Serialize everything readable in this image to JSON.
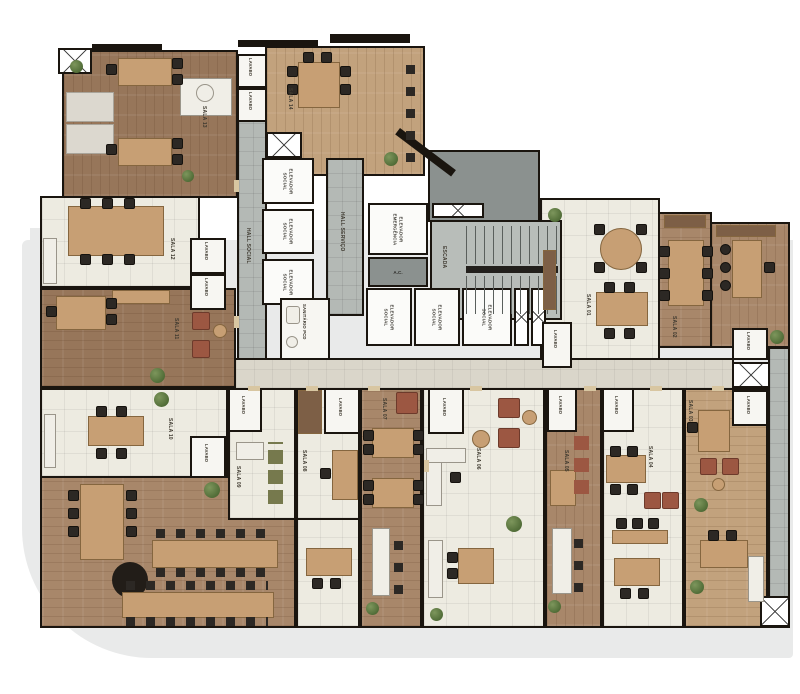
{
  "plan_type": "floor-plan",
  "labels": {
    "lavabo": "LAVABO",
    "elevador_social": "ELEVADOR SOCIAL",
    "elevador_emergencia": "ELEVADOR EMERGÊNCIA",
    "escada": "ESCADA",
    "hall_social": "HALL SOCIAL",
    "hall_servico": "HALL SERVIÇO",
    "ac": "A.C.",
    "sanitario_pcd": "SANITÁRIO PCD"
  },
  "salas": {
    "s01": "SALA 01",
    "s02": "SALA 02",
    "s03": "SALA 03",
    "s04": "SALA 04",
    "s05": "SALA 05",
    "s06": "SALA 06",
    "s07": "SALA 07",
    "s08": "SALA 08",
    "s09": "SALA 09",
    "s10": "SALA 10",
    "s11": "SALA 11",
    "s12": "SALA 12",
    "s13": "SALA 13",
    "s14": "SALA 14"
  },
  "colors": {
    "wall": "#1a150f",
    "wood_floor": "#a8876a",
    "wood_dark": "#97765a",
    "wood_light": "#c2a27d",
    "tile_floor": "#edebe1",
    "core_gray": "#b4b9b5",
    "corridor": "#dad6ca",
    "sidewalk": "#e9eaea",
    "desk": "#c79f74",
    "chair": "#2c2824",
    "sofa_green": "#76794d",
    "sofa_rust": "#9c5742",
    "plant": "#4e6a35"
  }
}
